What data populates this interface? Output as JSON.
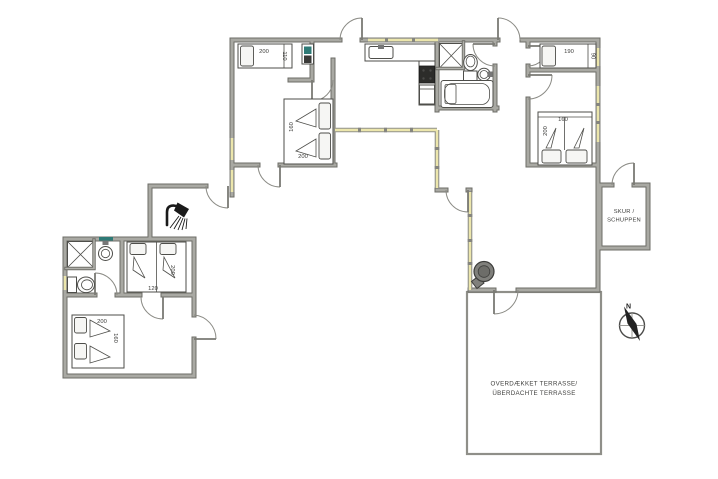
{
  "plan": {
    "type": "holiday-house-floor-plan",
    "colors": {
      "wall_fill": "#a9a9a3",
      "wall_edge": "#6d6d67",
      "window_glass": "#ece6ac",
      "appliance_teal": "#2e7a76",
      "appliance_dark": "#3a3a38",
      "stove_gray": "#80807c",
      "text": "#3b3b39"
    },
    "beds": {
      "bedroom_a_single_length": "200",
      "bedroom_a_single_width": "110",
      "bedroom_a_double_width": "160",
      "bedroom_a_double_length": "200",
      "bedroom_b_single_length": "190",
      "bedroom_b_single_width": "90",
      "bedroom_c_double_width": "160",
      "bedroom_c_double_length": "200",
      "annex_twin_length": "200",
      "annex_twin_width": "120",
      "annex_double_length": "200",
      "annex_double_width": "160"
    },
    "shed": {
      "line1": "SKUR /",
      "line2": "SCHUPPEN"
    },
    "terrace": {
      "line1": "OVERDÆKKET TERRASSE/",
      "line2": "ÜBERDACHTE TERRASSE"
    },
    "compass": {
      "north": "N"
    }
  }
}
